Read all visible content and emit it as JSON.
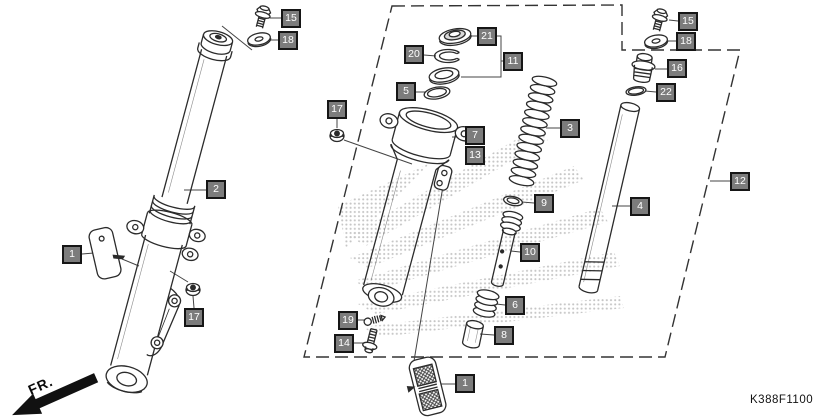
{
  "diagram": {
    "description": "Honda front fork exploded parts diagram",
    "part_code": "K388F1100",
    "fr_label": "FR.",
    "watermark": "honda-wing-halftone",
    "callouts": [
      {
        "id": "15-left",
        "label": "15"
      },
      {
        "id": "18-left",
        "label": "18"
      },
      {
        "id": "2",
        "label": "2"
      },
      {
        "id": "1-left",
        "label": "1"
      },
      {
        "id": "17-bottom",
        "label": "17"
      },
      {
        "id": "17-mid",
        "label": "17"
      },
      {
        "id": "20",
        "label": "20"
      },
      {
        "id": "21",
        "label": "21"
      },
      {
        "id": "11",
        "label": "11"
      },
      {
        "id": "5",
        "label": "5"
      },
      {
        "id": "7",
        "label": "7"
      },
      {
        "id": "13",
        "label": "13"
      },
      {
        "id": "3",
        "label": "3"
      },
      {
        "id": "9",
        "label": "9"
      },
      {
        "id": "10",
        "label": "10"
      },
      {
        "id": "6",
        "label": "6"
      },
      {
        "id": "8",
        "label": "8"
      },
      {
        "id": "19",
        "label": "19"
      },
      {
        "id": "14",
        "label": "14"
      },
      {
        "id": "1-bottom",
        "label": "1"
      },
      {
        "id": "15-right",
        "label": "15"
      },
      {
        "id": "18-right",
        "label": "18"
      },
      {
        "id": "16",
        "label": "16"
      },
      {
        "id": "22",
        "label": "22"
      },
      {
        "id": "4",
        "label": "4"
      },
      {
        "id": "12",
        "label": "12"
      }
    ],
    "colors": {
      "background": "#ffffff",
      "line": "#2b2b2b",
      "callout_bg": "#7c7c7c",
      "callout_border": "#161616",
      "callout_text": "#ffffff",
      "watermark_dots": "#bdbdbd"
    }
  }
}
